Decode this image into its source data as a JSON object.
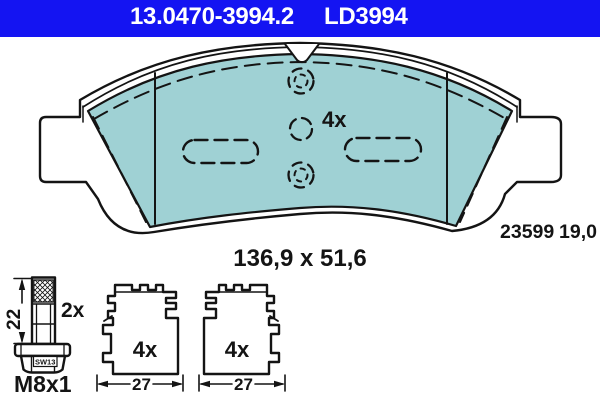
{
  "header": {
    "part_number": "13.0470-3994.2",
    "type_code": "LD3994",
    "bar_color": "#1414f2",
    "text_color": "#ffffff"
  },
  "brake_pad_view": {
    "quantity_label": "4x",
    "size_label": "136,9 x 51,6",
    "wva_number": "23599",
    "thickness_mm": "19,0",
    "pad_color": "#9fd1d4",
    "line_color": "#141414"
  },
  "accessories": {
    "guide_bolt": {
      "length_mm": "22",
      "quantity_label": "2x",
      "thread_label": "M8x1",
      "hex_size_label": "SW13"
    },
    "spring_clip_left": {
      "quantity_label": "4x",
      "width_mm": "27"
    },
    "spring_clip_right": {
      "quantity_label": "4x",
      "width_mm": "27"
    }
  }
}
